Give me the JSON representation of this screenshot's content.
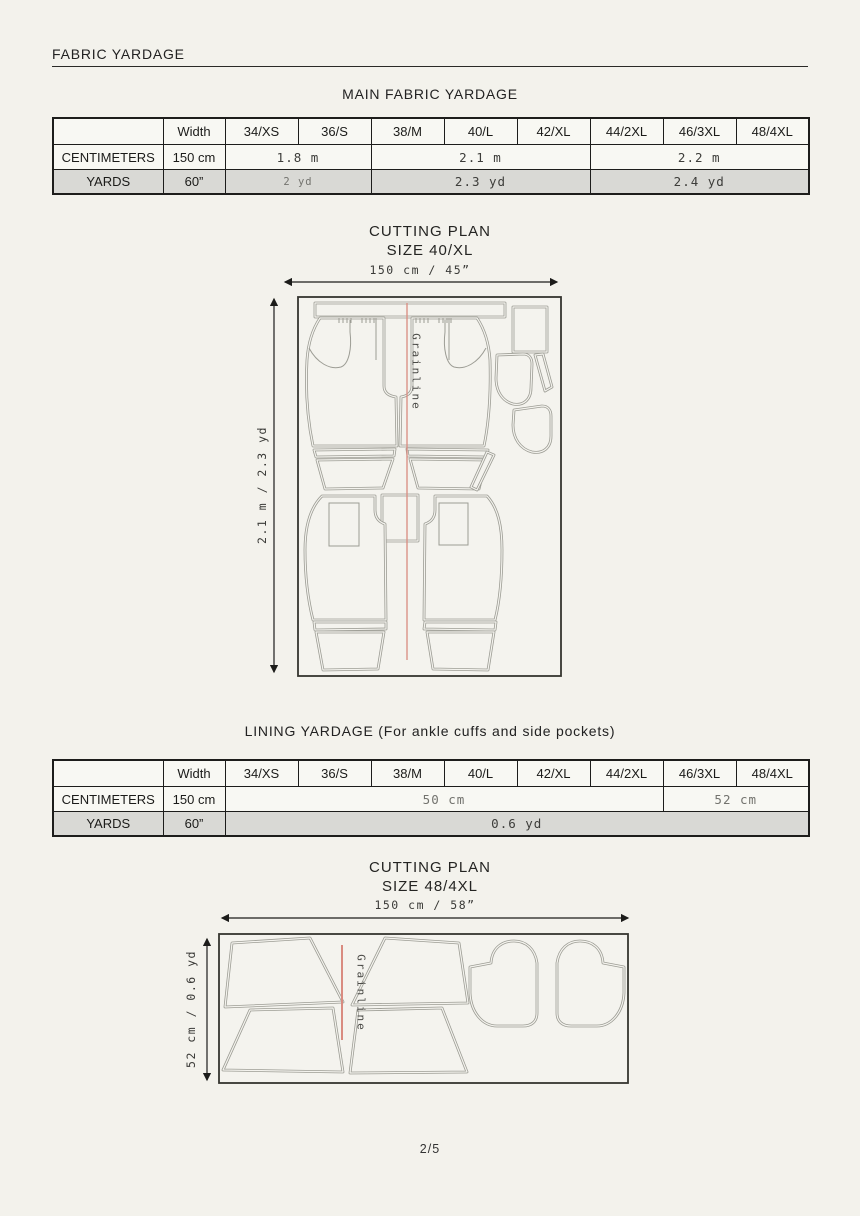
{
  "header": {
    "title": "FABRIC YARDAGE"
  },
  "size_columns": [
    "34/XS",
    "36/S",
    "38/M",
    "40/L",
    "42/XL",
    "44/2XL",
    "46/3XL",
    "48/4XL"
  ],
  "main_yardage": {
    "title": "MAIN FABRIC YARDAGE",
    "width_label": "Width",
    "centimeters": {
      "label": "CENTIMETERS",
      "width": "150 cm",
      "values": [
        {
          "text": "1.8 m",
          "span": 2
        },
        {
          "text": "2.1 m",
          "span": 3
        },
        {
          "text": "2.2 m",
          "span": 3
        }
      ]
    },
    "yards": {
      "label": "YARDS",
      "width": "60”",
      "values": [
        {
          "text": "2 yd",
          "span": 2
        },
        {
          "text": "2.3 yd",
          "span": 3
        },
        {
          "text": "2.4 yd",
          "span": 3
        }
      ]
    }
  },
  "cutting_plan_main": {
    "title": "CUTTING PLAN",
    "subtitle": "SIZE 40/XL",
    "width_dimension": "150 cm / 45”",
    "length_dimension": "2.1 m / 2.3 yd",
    "grainline": "Grainline"
  },
  "lining_yardage": {
    "title": "LINING YARDAGE (For ankle cuffs and side pockets)",
    "width_label": "Width",
    "centimeters": {
      "label": "CENTIMETERS",
      "width": "150 cm",
      "values": [
        {
          "text": "50 cm",
          "span": 6
        },
        {
          "text": "52 cm",
          "span": 2
        }
      ]
    },
    "yards": {
      "label": "YARDS",
      "width": "60”",
      "values": [
        {
          "text": "0.6 yd",
          "span": 8
        }
      ]
    }
  },
  "cutting_plan_lining": {
    "title": "CUTTING PLAN",
    "subtitle": "SIZE 48/4XL",
    "width_dimension": "150 cm / 58”",
    "length_dimension": "52 cm / 0.6 yd",
    "grainline": "Grainline"
  },
  "footer": {
    "page_number": "2/5"
  },
  "colors": {
    "grainline_red": "#d98b80",
    "grainline_red_light": "#efaca3",
    "piece_outline": "#9c9c94",
    "shaded_row": "#d9d9d5",
    "ink": "#1d1d1b"
  }
}
